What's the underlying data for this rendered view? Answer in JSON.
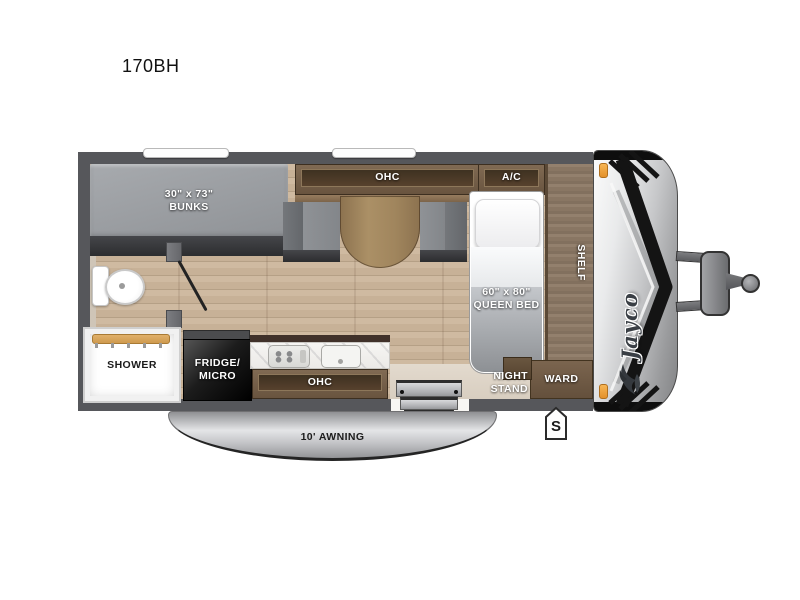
{
  "model": "170BH",
  "brand": "Jayco",
  "rooms": {
    "bunks": {
      "size": "30\" x 73\"",
      "label": "BUNKS"
    },
    "dinette_ohc": "OHC",
    "ac": "A/C",
    "queen_bed": {
      "size": "60\" x 80\"",
      "label": "QUEEN BED"
    },
    "shelf": "SHELF",
    "night_stand": {
      "line1": "NIGHT",
      "line2": "STAND"
    },
    "ward": "WARD",
    "shower": "SHOWER",
    "fridge": {
      "line1": "FRIDGE/",
      "line2": "MICRO"
    },
    "kitchen_ohc": "OHC",
    "awning": "10' AWNING",
    "spare_marker": "S"
  },
  "colors": {
    "wall": "#56575b",
    "floor": "#c7b197",
    "cabinet": "#75604c",
    "cabinet-dark": "#473827",
    "table": "#a1865e",
    "shelf-wood": "#8b7765",
    "mattress": "#9da0a4",
    "cream": "#ded4c6",
    "fridge": "#161616",
    "awning-silver": "#c3c4c6",
    "cap-silver": "#d3d4d6",
    "amber": "#f2a53e",
    "label": "#ffffff",
    "ink": "#1c1c1c"
  }
}
